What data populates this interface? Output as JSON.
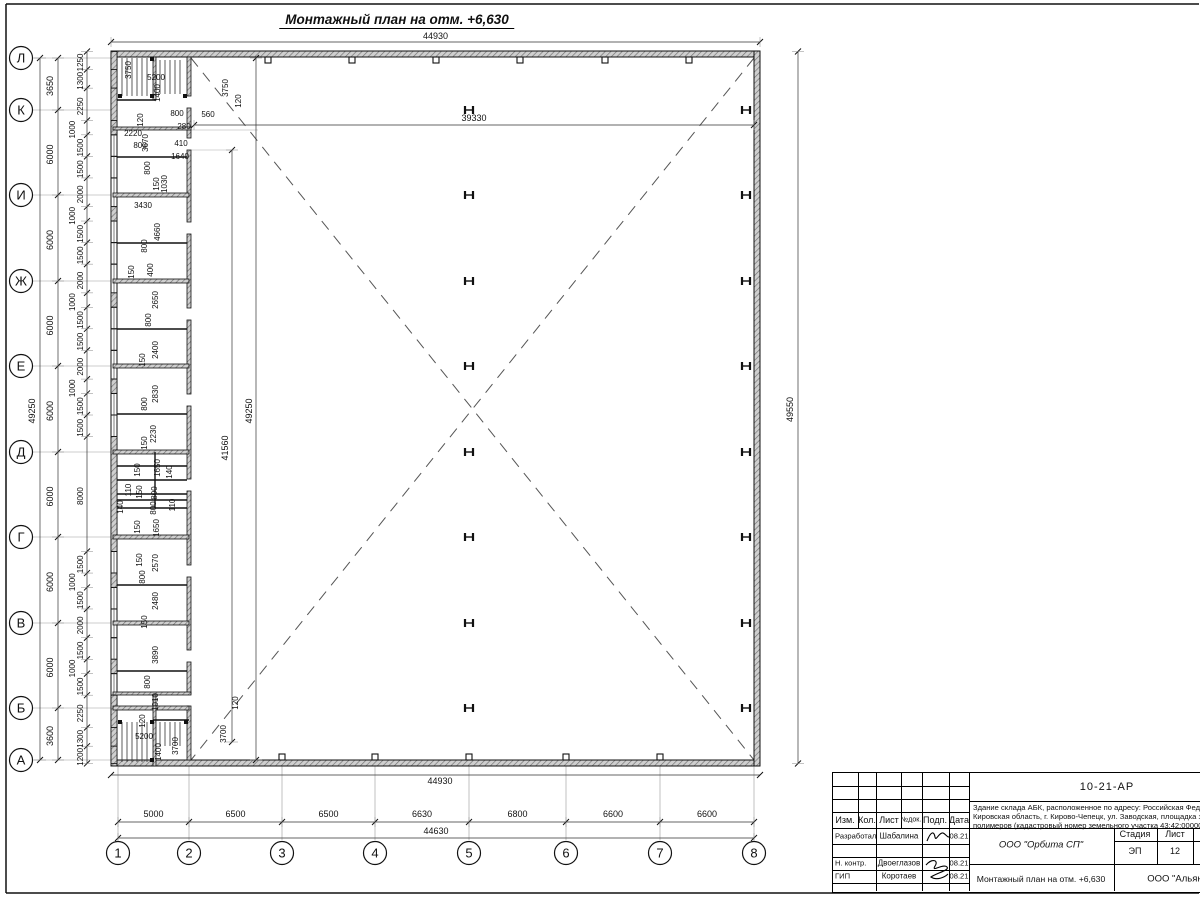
{
  "sheet": {
    "title": "Монтажный план на отм. +6,630"
  },
  "axes": {
    "rows": [
      "Л",
      "К",
      "И",
      "Ж",
      "Е",
      "Д",
      "Г",
      "В",
      "Б",
      "А"
    ],
    "row_spacings": [
      "3650",
      "6000",
      "6000",
      "6000",
      "6000",
      "6000",
      "6000",
      "6000",
      "3600"
    ],
    "cols": [
      "1",
      "2",
      "3",
      "4",
      "5",
      "6",
      "7",
      "8"
    ],
    "col_spacings": [
      "5000",
      "6500",
      "6500",
      "6630",
      "6800",
      "6600",
      "6600"
    ]
  },
  "dims": {
    "top_width": "44930",
    "bottom_width": "44930",
    "bottom_overall": "44630",
    "left_overall": "49250",
    "right_height": "49550",
    "hall_width": "39330",
    "hall_height_1": "41560",
    "hall_height_2": "49250",
    "left_chain": [
      1250,
      1300,
      2250,
      1000,
      1500,
      1500,
      2000,
      1000,
      1500,
      1500,
      2000,
      1000,
      1500,
      1500,
      2000,
      1000,
      1500,
      1500,
      8000,
      1500,
      1000,
      1500,
      2000,
      1500,
      1000,
      1500,
      2250,
      1300,
      1200
    ]
  },
  "annotations": [
    {
      "t": "3750",
      "x": 131,
      "y": 70,
      "r": 1
    },
    {
      "t": "5200",
      "x": 156,
      "y": 80
    },
    {
      "t": "1400",
      "x": 160,
      "y": 93,
      "r": 1
    },
    {
      "t": "120",
      "x": 143,
      "y": 120,
      "r": 1
    },
    {
      "t": "800",
      "x": 177,
      "y": 116
    },
    {
      "t": "560",
      "x": 208,
      "y": 117
    },
    {
      "t": "280",
      "x": 184,
      "y": 129
    },
    {
      "t": "2220",
      "x": 133,
      "y": 136
    },
    {
      "t": "800",
      "x": 140,
      "y": 148
    },
    {
      "t": "3670",
      "x": 148,
      "y": 143,
      "r": 1
    },
    {
      "t": "410",
      "x": 181,
      "y": 146
    },
    {
      "t": "1640",
      "x": 180,
      "y": 159
    },
    {
      "t": "800",
      "x": 150,
      "y": 168,
      "r": 1
    },
    {
      "t": "3750",
      "x": 228,
      "y": 88,
      "r": 1
    },
    {
      "t": "120",
      "x": 241,
      "y": 101,
      "r": 1
    },
    {
      "t": "150",
      "x": 159,
      "y": 184,
      "r": 1
    },
    {
      "t": "1030",
      "x": 167,
      "y": 184,
      "r": 1
    },
    {
      "t": "3430",
      "x": 143,
      "y": 208
    },
    {
      "t": "4660",
      "x": 160,
      "y": 232,
      "r": 1
    },
    {
      "t": "800",
      "x": 147,
      "y": 246,
      "r": 1
    },
    {
      "t": "400",
      "x": 153,
      "y": 270,
      "r": 1
    },
    {
      "t": "150",
      "x": 134,
      "y": 272,
      "r": 1
    },
    {
      "t": "2650",
      "x": 158,
      "y": 300,
      "r": 1
    },
    {
      "t": "800",
      "x": 151,
      "y": 320,
      "r": 1
    },
    {
      "t": "2400",
      "x": 158,
      "y": 350,
      "r": 1
    },
    {
      "t": "150",
      "x": 145,
      "y": 360,
      "r": 1
    },
    {
      "t": "2830",
      "x": 158,
      "y": 394,
      "r": 1
    },
    {
      "t": "800",
      "x": 147,
      "y": 404,
      "r": 1
    },
    {
      "t": "2230",
      "x": 156,
      "y": 434,
      "r": 1
    },
    {
      "t": "150",
      "x": 147,
      "y": 443,
      "r": 1
    },
    {
      "t": "1650",
      "x": 160,
      "y": 468,
      "r": 1
    },
    {
      "t": "150",
      "x": 140,
      "y": 470,
      "r": 1
    },
    {
      "t": "140",
      "x": 172,
      "y": 472,
      "r": 1
    },
    {
      "t": "110",
      "x": 131,
      "y": 490,
      "r": 1
    },
    {
      "t": "150",
      "x": 142,
      "y": 492,
      "r": 1
    },
    {
      "t": "800",
      "x": 157,
      "y": 493,
      "r": 1
    },
    {
      "t": "140",
      "x": 123,
      "y": 507,
      "r": 1
    },
    {
      "t": "800",
      "x": 156,
      "y": 508,
      "r": 1
    },
    {
      "t": "110",
      "x": 175,
      "y": 505,
      "r": 1
    },
    {
      "t": "150",
      "x": 140,
      "y": 527,
      "r": 1
    },
    {
      "t": "1650",
      "x": 159,
      "y": 528,
      "r": 1
    },
    {
      "t": "150",
      "x": 142,
      "y": 560,
      "r": 1
    },
    {
      "t": "2570",
      "x": 158,
      "y": 563,
      "r": 1
    },
    {
      "t": "800",
      "x": 145,
      "y": 577,
      "r": 1
    },
    {
      "t": "2480",
      "x": 158,
      "y": 601,
      "r": 1
    },
    {
      "t": "150",
      "x": 147,
      "y": 622,
      "r": 1
    },
    {
      "t": "3890",
      "x": 158,
      "y": 655,
      "r": 1
    },
    {
      "t": "800",
      "x": 150,
      "y": 682,
      "r": 1
    },
    {
      "t": "1010",
      "x": 158,
      "y": 702,
      "r": 1
    },
    {
      "t": "120",
      "x": 145,
      "y": 721,
      "r": 1
    },
    {
      "t": "5200",
      "x": 144,
      "y": 739
    },
    {
      "t": "1400",
      "x": 161,
      "y": 752,
      "r": 1
    },
    {
      "t": "3700",
      "x": 178,
      "y": 746,
      "r": 1
    },
    {
      "t": "120",
      "x": 238,
      "y": 703,
      "r": 1
    },
    {
      "t": "3700",
      "x": 226,
      "y": 734,
      "r": 1
    }
  ],
  "title_block": {
    "doc_number": "10-21-АР",
    "address_lines": [
      "Здание склада АБК, расположенное по адресу: Российская Федерация,",
      "Кировская область, г. Кирово-Чепецк, ул. Заводская, площадка завода",
      "полимеров (кадастровый номер земельного участка 43:42:000000:0000)"
    ],
    "header_cols": [
      "Изм.",
      "Кол.",
      "Лист",
      "№док.",
      "Подп.",
      "Дата"
    ],
    "sign_rows": [
      {
        "role": "Разработал",
        "name": "Шабалина",
        "date": "08.21"
      },
      {
        "role": "Н. контр.",
        "name": "Двоеглазов",
        "date": "08.21"
      },
      {
        "role": "ГИП",
        "name": "Коротаев",
        "date": "08.21"
      }
    ],
    "org": "ООО \"Орбита СП\"",
    "stage_label": "Стадия",
    "sheet_label": "Лист",
    "sheets_label": "Листов",
    "stage": "ЭП",
    "sheet_no": "12",
    "sheets_total": "1",
    "drawing_title": "Монтажный план на отм. +6,630",
    "company": "ООО \"Альянс\""
  }
}
